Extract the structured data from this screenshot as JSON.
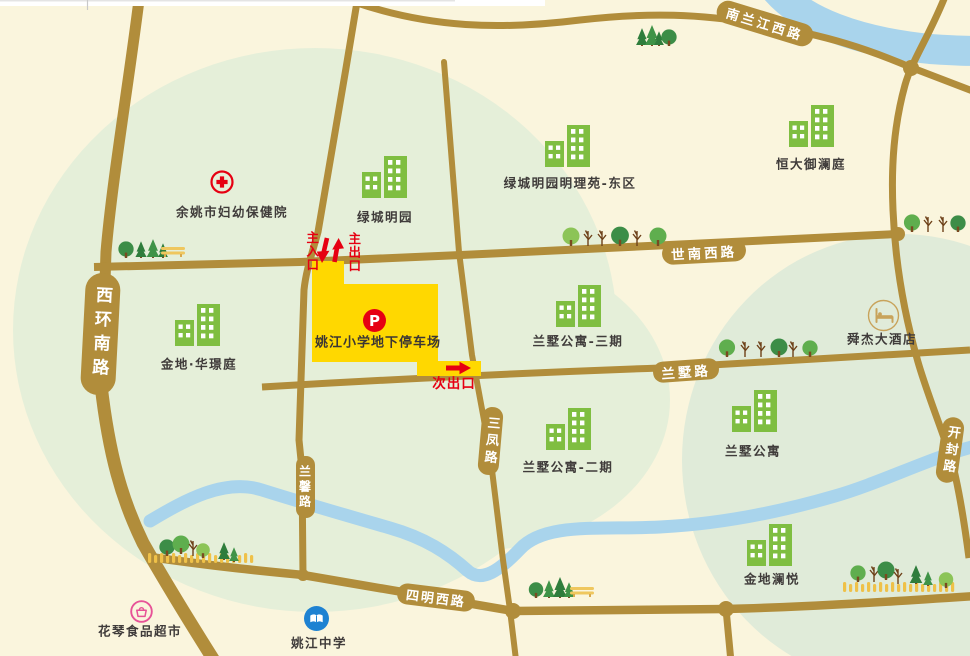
{
  "map": {
    "parking": {
      "label": "姚江小学地下停车场",
      "marker": "P"
    },
    "entrances": {
      "main_entrance": "主入口",
      "main_exit": "主出口",
      "secondary_exit": "次出口"
    },
    "roads": [
      {
        "id": "xihuannanlu",
        "label": "西环南路"
      },
      {
        "id": "nanlanjiangxilu",
        "label": "南兰江西路"
      },
      {
        "id": "shinanxilu",
        "label": "世南西路"
      },
      {
        "id": "lanshulu",
        "label": "兰墅路"
      },
      {
        "id": "sanfenglu",
        "label": "三凤路"
      },
      {
        "id": "lanxinlu",
        "label": "兰馨路"
      },
      {
        "id": "simingxilu",
        "label": "四明西路"
      },
      {
        "id": "kaifenglu",
        "label": "开封路"
      }
    ],
    "pois": [
      {
        "id": "yuyao_hospital",
        "type": "hospital",
        "label": "余姚市妇幼保健院"
      },
      {
        "id": "lvcheng_mingyuan",
        "type": "building",
        "label": "绿城明园"
      },
      {
        "id": "mingliyuan",
        "type": "building",
        "label": "绿城明园明理苑-东区"
      },
      {
        "id": "hengda",
        "type": "building",
        "label": "恒大御澜庭"
      },
      {
        "id": "jindi_huajing",
        "type": "building",
        "label": "金地·华璟庭"
      },
      {
        "id": "lanshu_3",
        "type": "building",
        "label": "兰墅公寓-三期"
      },
      {
        "id": "lanshu_2",
        "type": "building",
        "label": "兰墅公寓-二期"
      },
      {
        "id": "lanshu",
        "type": "building",
        "label": "兰墅公寓"
      },
      {
        "id": "jindi_lanyue",
        "type": "building",
        "label": "金地澜悦"
      },
      {
        "id": "shunjie_hotel",
        "type": "hotel",
        "label": "舜杰大酒店"
      },
      {
        "id": "huaqin_market",
        "type": "market",
        "label": "花琴食品超市"
      },
      {
        "id": "yaojiang_school",
        "type": "school",
        "label": "姚江中学"
      }
    ]
  },
  "colors": {
    "background": "#FAF5DD",
    "zone_green_left": "#E5EFD9",
    "zone_green_right": "#E0EBD9",
    "road": "#B18D3B",
    "river": "#A9D4EC",
    "parking_yellow": "#FFD800",
    "accent_red": "#E60012",
    "building_green": "#7FBE41",
    "label_text": "#3F3B3A",
    "school_blue": "#1E82D2",
    "market_pink": "#E75297",
    "hotel_tan": "#C8A35B"
  }
}
